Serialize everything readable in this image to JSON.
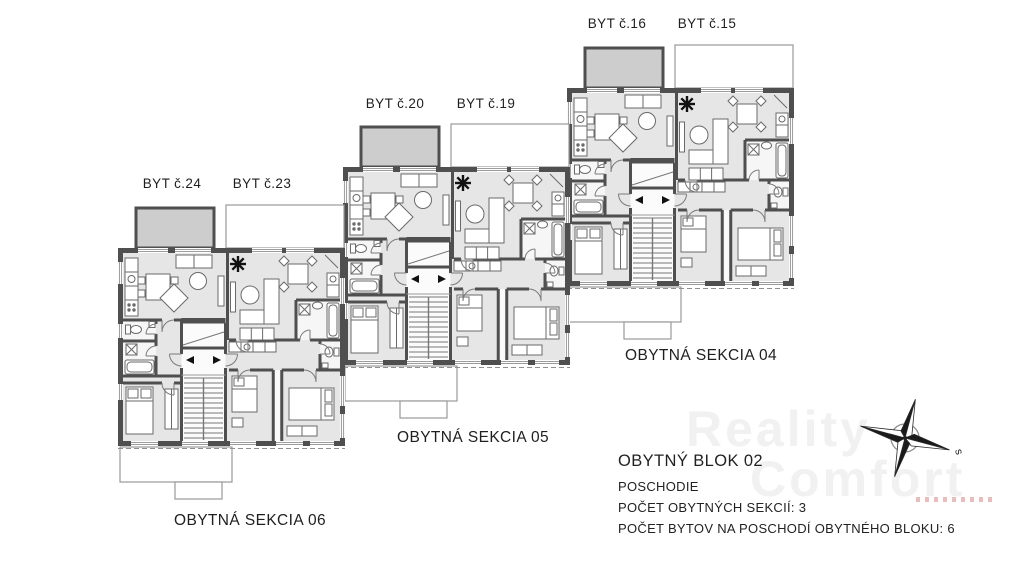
{
  "apartments": [
    {
      "id": "byt-24",
      "label": "BYT č.24"
    },
    {
      "id": "byt-23",
      "label": "BYT č.23"
    },
    {
      "id": "byt-20",
      "label": "BYT č.20"
    },
    {
      "id": "byt-19",
      "label": "BYT č.19"
    },
    {
      "id": "byt-16",
      "label": "BYT č.16"
    },
    {
      "id": "byt-15",
      "label": "BYT č.15"
    }
  ],
  "sections": [
    {
      "id": "sekcia-04",
      "label": "OBYTNÁ SEKCIA 04"
    },
    {
      "id": "sekcia-05",
      "label": "OBYTNÁ SEKCIA 05"
    },
    {
      "id": "sekcia-06",
      "label": "OBYTNÁ SEKCIA 06"
    }
  ],
  "info": {
    "title": "OBYTNÝ BLOK 02",
    "line1": "POSCHODIE",
    "line2": "POČET OBYTNÝCH SEKCIÍ: 3",
    "line3": "POČET BYTOV NA POSCHODÍ OBYTNÉHO BLOKU: 6"
  },
  "compass": {
    "label": "s"
  },
  "watermark": {
    "line1": "Reality",
    "line2": "Comfort"
  },
  "colors": {
    "wall": "#4f4f4f",
    "room_fill": "#e6e6e6",
    "balcony_fill": "#cdcdcd",
    "text": "#1f1f1f",
    "watermark": "#f1f1f1"
  }
}
